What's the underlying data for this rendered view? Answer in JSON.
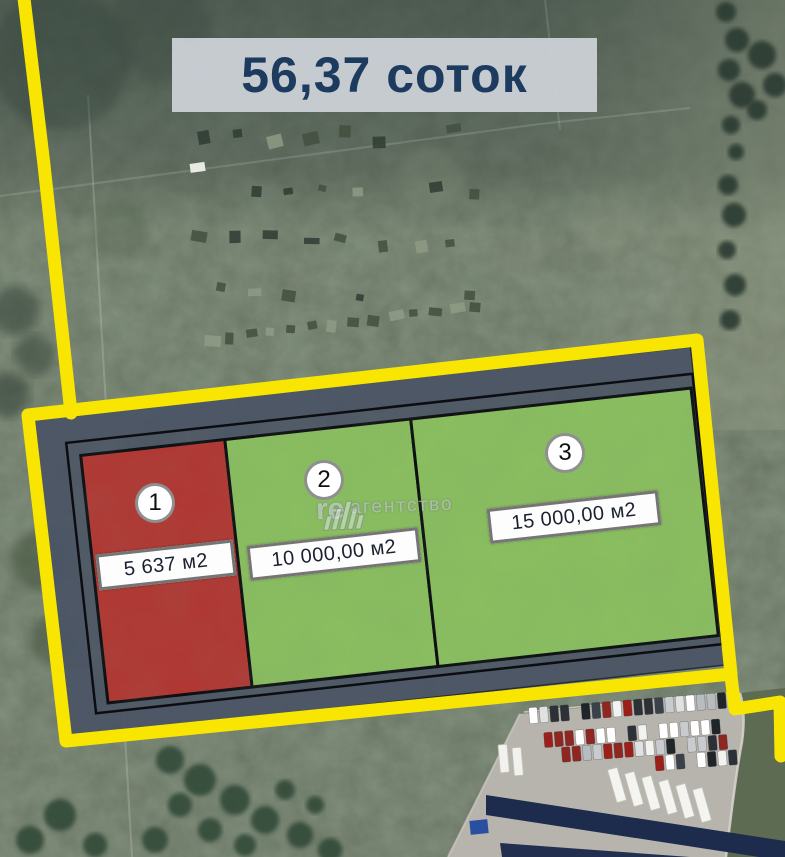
{
  "banner": {
    "area_label": "56,37 соток"
  },
  "plots": [
    {
      "number": "1",
      "area_label": "5 637 м2",
      "color": "#b23531"
    },
    {
      "number": "2",
      "area_label": "10 000,00 м2",
      "color": "#8abf5e"
    },
    {
      "number": "3",
      "area_label": "15 000,00 м2",
      "color": "#8abf5e"
    }
  ],
  "watermark": {
    "prefix": "re",
    "suffix": "агентство"
  },
  "colors": {
    "boundary_yellow": "#f8e602",
    "master_area_gray": "#4b5565",
    "outline_black": "#0b0d10",
    "banner_bg": "#c9ced4",
    "banner_text": "#1d3b5e"
  }
}
